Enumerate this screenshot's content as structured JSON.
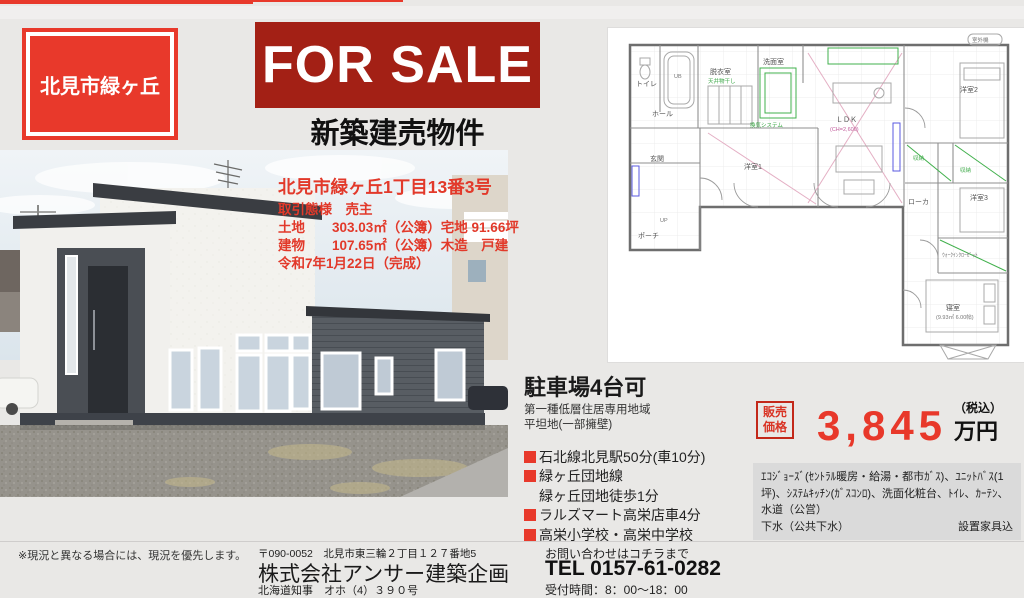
{
  "badges": {
    "location": "北見市緑ヶ丘",
    "quality": "長期優良住宅"
  },
  "banner": {
    "title": "FOR SALE",
    "subtitle": "新築建売物件"
  },
  "property": {
    "address": "北見市緑ヶ丘1丁目13番3号",
    "transaction": "取引態様　売主",
    "land": "土地　　303.03㎡（公簿）宅地 91.66坪",
    "building": "建物　　107.65㎡（公簿）木造　戸建",
    "completion": "令和7年1月22日（完成）"
  },
  "details": {
    "parking": "駐車場4台可",
    "zoning": "第一種低層住居専用地域",
    "terrain": "平坦地(一部擁壁)",
    "access": [
      "石北線北見駅50分(車10分)",
      "緑ヶ丘団地線",
      "緑ヶ丘団地徒歩1分",
      "ラルズマート高栄店車4分",
      "高栄小学校・高栄中学校"
    ]
  },
  "price": {
    "label": "販売価格",
    "amount": "3,845",
    "tax_note": "（税込）",
    "unit": "万円"
  },
  "equipment": {
    "line1": "ｴｺｼﾞｮｰｽﾞ(ｾﾝﾄﾗﾙ暖房・給湯・都市ｶﾞｽ)、ﾕﾆｯﾄﾊﾞｽ(1坪)、ｼｽﾃﾑｷｯﾁﾝ(ｶﾞｽｺﾝﾛ)、洗面化粧台、ﾄｲﾚ、ｶｰﾃﾝ、水道（公営）",
    "line2": "下水（公共下水）",
    "note": "設置家具込"
  },
  "footer": {
    "disclaimer": "※現況と異なる場合には、現況を優先します。",
    "postal_address": "〒090-0052　北見市東三輪２丁目１２７番地5",
    "company": "株式会社アンサー建築企画",
    "license": "北海道知事　オホ（4）３９０号",
    "contact_lead": "お問い合わせはコチラまで",
    "tel": "TEL 0157-61-0282",
    "hours": "受付時間：8：00～18：00"
  },
  "floorplan": {
    "labels": [
      "トイレ",
      "UB",
      "脱衣室",
      "天井物干し",
      "洗面室",
      "換気システム",
      "ホール",
      "玄関",
      "UP",
      "ポーチ",
      "洋室1",
      "ＬＤＫ",
      "(CH=2,600)",
      "洋室2",
      "収納",
      "収納",
      "ローカ",
      "洋室3",
      "ｳｫｰｸｲﾝｸﾛｰｾﾞｯﾄ",
      "寝室",
      "(9.93㎡ 6.00帖)",
      "室外機"
    ]
  },
  "colors": {
    "accent_red": "#e8392b",
    "banner_red": "#a32015",
    "price_red": "#e8382a"
  }
}
